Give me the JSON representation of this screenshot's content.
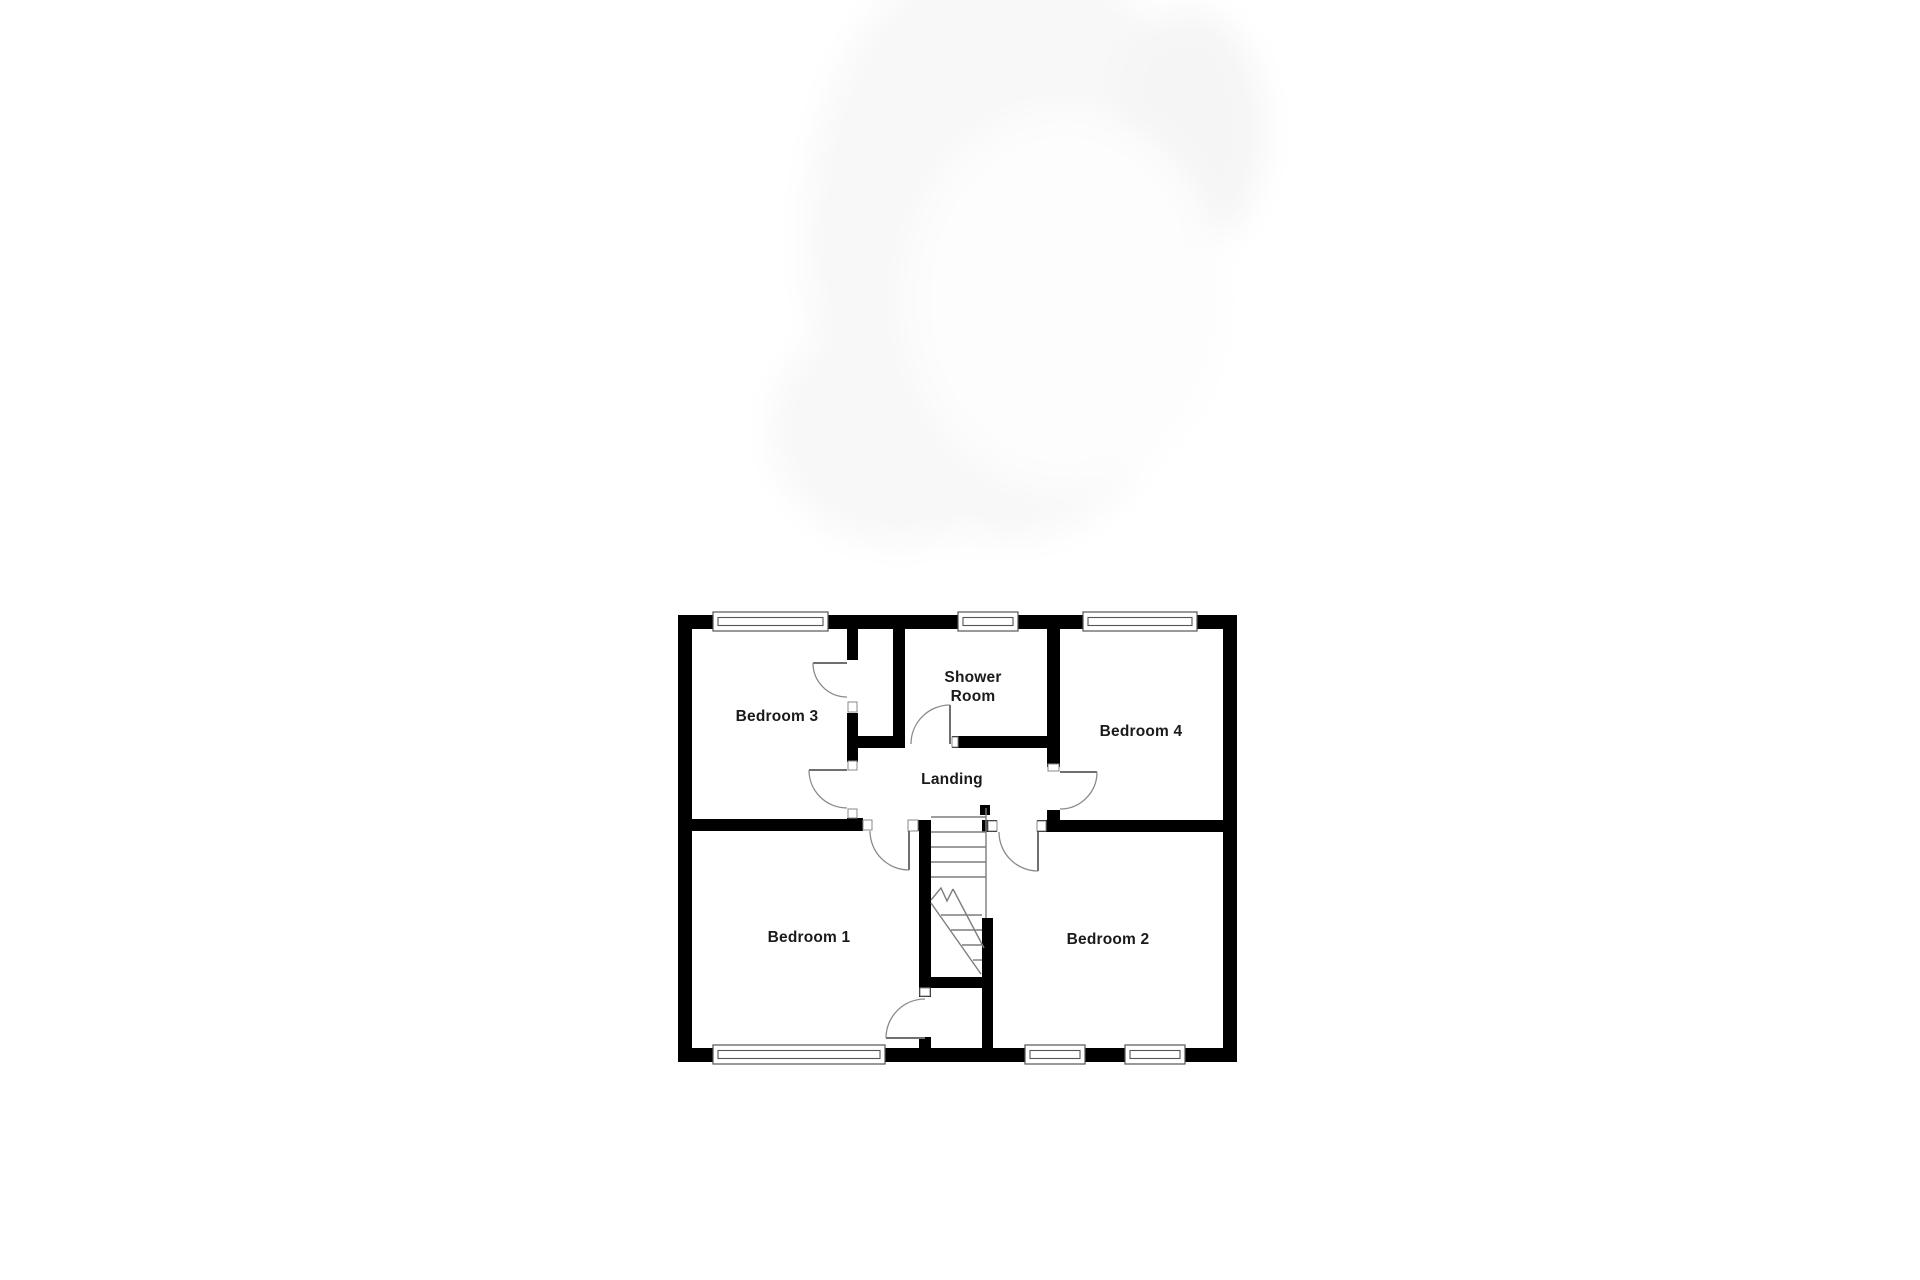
{
  "page": {
    "background_color": "#ffffff",
    "description_labels_only": true
  },
  "floor_plan": {
    "labels": {
      "bedroom3": "Bedroom 3",
      "shower_room_line1": "Shower",
      "shower_room_line2": "Room",
      "bedroom4": "Bedroom 4",
      "landing": "Landing",
      "bedroom1": "Bedroom 1",
      "bedroom2": "Bedroom 2"
    },
    "colors": {
      "wall": "#000000",
      "door_line": "#8a8a8a",
      "window_frame": "#555555",
      "stair_line": "#7d7d7d",
      "label_text": "#1a1a1a",
      "watermark": "#f8f8f8"
    },
    "counts": {
      "windows": 6,
      "doors": 7,
      "rooms_labeled": 6
    }
  }
}
